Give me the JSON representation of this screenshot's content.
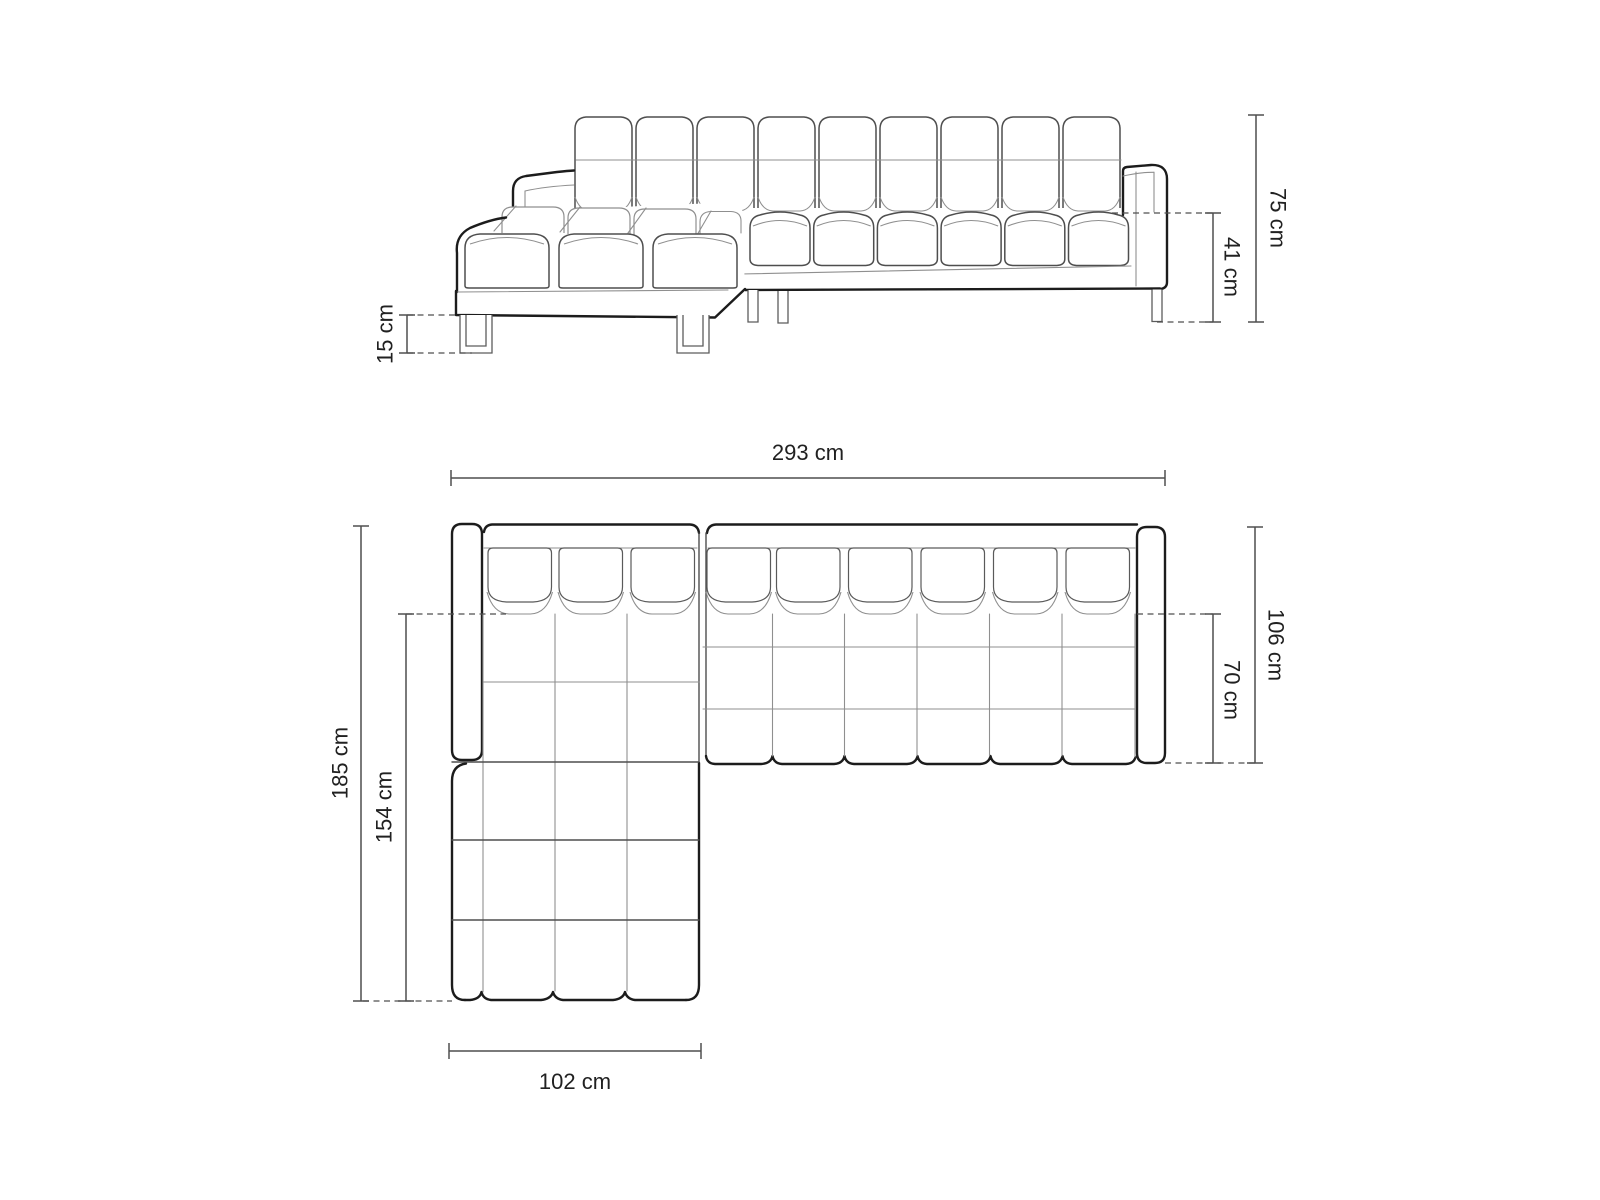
{
  "page": {
    "background": "#ffffff"
  },
  "style": {
    "outline_heavy": "#1c1c1c",
    "outline_medium": "#4e4e4e",
    "outline_light": "#8f8f8f",
    "dimension_color": "#4f4f4f",
    "text_color": "#212121"
  },
  "views": {
    "front": {
      "name": "front-elevation",
      "dimensions": [
        {
          "id": "overall-height",
          "label": "75 cm",
          "value_cm": 75
        },
        {
          "id": "seat-height",
          "label": "41 cm",
          "value_cm": 41
        },
        {
          "id": "leg-height",
          "label": "15 cm",
          "value_cm": 15
        }
      ]
    },
    "plan": {
      "name": "top-plan",
      "dimensions": [
        {
          "id": "overall-width",
          "label": "293 cm",
          "value_cm": 293
        },
        {
          "id": "overall-depth",
          "label": "106 cm",
          "value_cm": 106
        },
        {
          "id": "seat-depth",
          "label": "70 cm",
          "value_cm": 70
        },
        {
          "id": "chaise-total-depth",
          "label": "185 cm",
          "value_cm": 185
        },
        {
          "id": "chaise-seat-depth",
          "label": "154 cm",
          "value_cm": 154
        },
        {
          "id": "chaise-width",
          "label": "102 cm",
          "value_cm": 102
        }
      ]
    }
  }
}
